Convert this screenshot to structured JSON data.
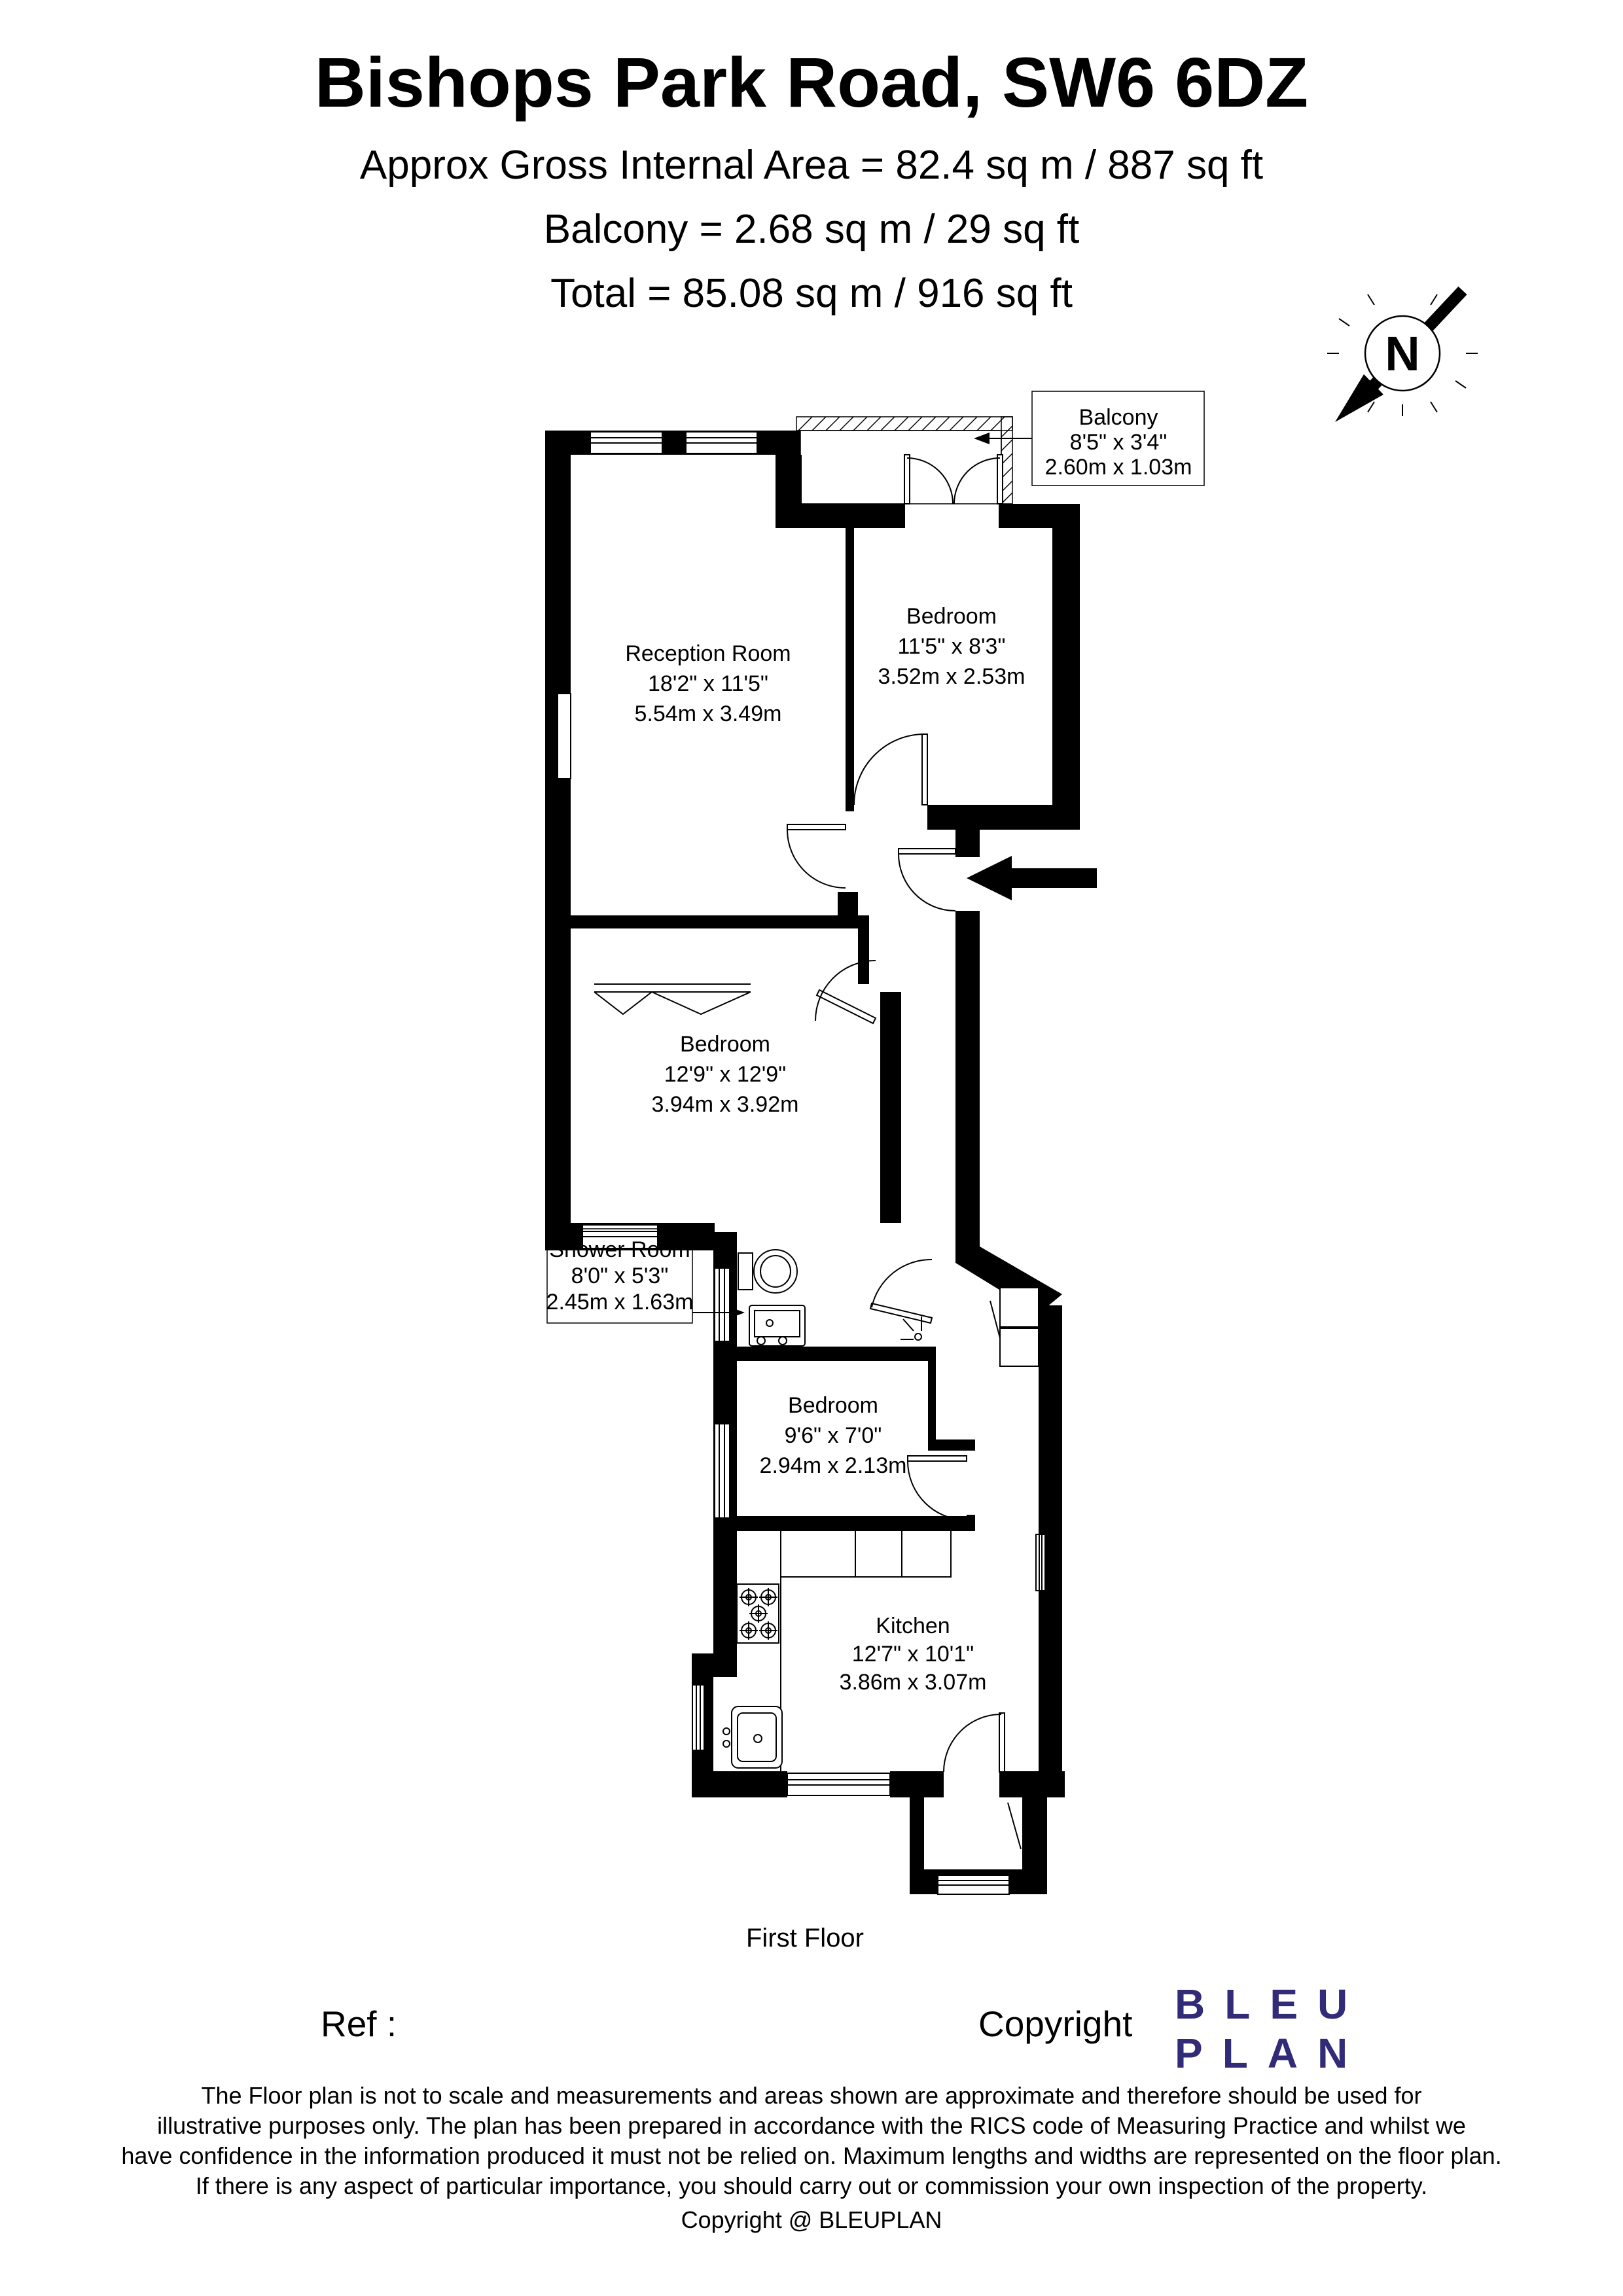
{
  "header": {
    "title": "Bishops Park Road, SW6 6DZ",
    "subtitle1": "Approx Gross Internal Area = 82.4 sq m / 887 sq ft",
    "subtitle2": "Balcony = 2.68 sq m / 29 sq ft",
    "subtitle3": "Total = 85.08 sq m / 916 sq ft"
  },
  "north": {
    "label": "N"
  },
  "rooms": [
    {
      "name": "Reception Room",
      "dims_ft": "18'2\" x 11'5\"",
      "dims_m": "5.54m x 3.49m"
    },
    {
      "name": "Bedroom",
      "dims_ft": "11'5\" x 8'3\"",
      "dims_m": "3.52m x 2.53m"
    },
    {
      "name": "Bedroom",
      "dims_ft": "12'9\" x 12'9\"",
      "dims_m": "3.94m x 3.92m"
    },
    {
      "name": "Bedroom",
      "dims_ft": "9'6\" x 7'0\"",
      "dims_m": "2.94m x 2.13m"
    },
    {
      "name": "Kitchen",
      "dims_ft": "12'7\" x 10'1\"",
      "dims_m": "3.86m x 3.07m"
    }
  ],
  "callouts": {
    "balcony": {
      "title": "Balcony",
      "dims_ft": "8'5\" x 3'4\"",
      "dims_m": "2.60m x 1.03m"
    },
    "shower": {
      "title": "Shower Room",
      "dims_ft": "8'0\" x 5'3\"",
      "dims_m": "2.45m x 1.63m"
    }
  },
  "floor_label": "First Floor",
  "footer": {
    "ref_label": "Ref  :",
    "copyright_label": "Copyright",
    "logo_line1": "BLEU",
    "logo_line2": "PLAN",
    "logo_color": "#312b78",
    "disclaimer": [
      "The Floor plan is not to scale and measurements and areas shown are approximate and therefore should be used for",
      "illustrative purposes only. The plan has been prepared in accordance with the RICS code of Measuring Practice and whilst we",
      "have confidence in the information produced it must not be relied on. Maximum lengths and widths are represented on the floor plan.",
      "If there is any aspect of particular importance, you should carry out or commission your own inspection of the property."
    ],
    "copyright_line": "Copyright @ BLEUPLAN"
  }
}
